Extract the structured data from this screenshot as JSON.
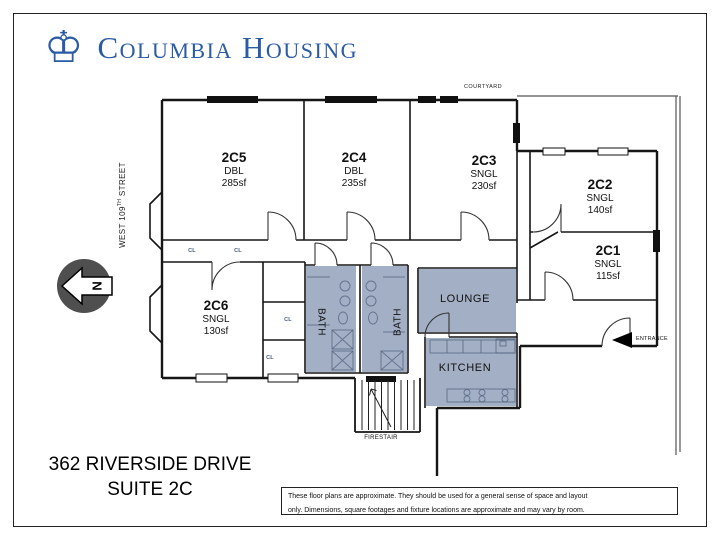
{
  "logo": {
    "icon": "columbia-crown-icon",
    "icon_glyph": "♔",
    "text": "Columbia Housing"
  },
  "plan": {
    "courtyard_label": "COURTYARD",
    "street_label_prefix": "WEST 109",
    "street_label_sup": "TH",
    "street_label_suffix": " STREET",
    "north_label": "N",
    "firestair_label": "FIRESTAIR",
    "entrance_label": "ENTRANCE",
    "closet_label": "CL",
    "rooms": [
      {
        "id": "2C5",
        "type": "DBL",
        "area": "285sf"
      },
      {
        "id": "2C4",
        "type": "DBL",
        "area": "235sf"
      },
      {
        "id": "2C3",
        "type": "SNGL",
        "area": "230sf"
      },
      {
        "id": "2C2",
        "type": "SNGL",
        "area": "140sf"
      },
      {
        "id": "2C1",
        "type": "SNGL",
        "area": "115sf"
      },
      {
        "id": "2C6",
        "type": "SNGL",
        "area": "130sf"
      }
    ],
    "areas": {
      "lounge": "LOUNGE",
      "kitchen": "KITCHEN",
      "bath_left": "BATH",
      "bath_right": "BATH"
    }
  },
  "footer": {
    "address_line1": "362 RIVERSIDE DRIVE",
    "address_line2": "SUITE 2C",
    "disclaimer_line1": "These floor plans are approximate. They should be used for a general sense of space and layout",
    "disclaimer_line2": "only. Dimensions, square footages and fixture locations are approximate and may vary by room."
  },
  "colors": {
    "logo_color": "#2b5ba5",
    "shade_color": "#a3afc4",
    "wall_color": "#161616",
    "closet_color": "#44597e",
    "north_color": "#4f4f4f"
  }
}
